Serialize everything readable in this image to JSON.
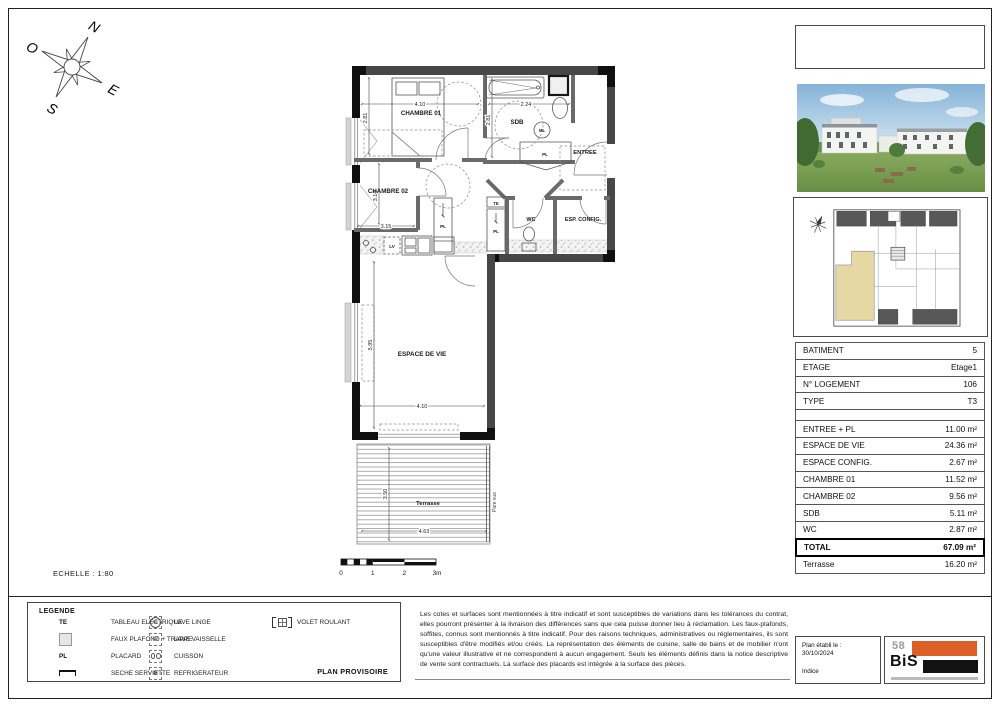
{
  "page": {
    "scale_label": "ECHELLE : 1:80",
    "plan_status": "PLAN PROVISOIRE"
  },
  "compass": {
    "n": "N",
    "o": "O",
    "e": "E",
    "s": "S"
  },
  "plan": {
    "rooms": {
      "chambre01": "CHAMBRE 01",
      "sdb": "SDB",
      "entree": "ENTREE",
      "chambre02": "CHAMBRE 02",
      "wc": "WC",
      "esp_config": "ESP. CONFIG.",
      "espace_de_vie": "ESPACE DE VIE",
      "terrasse": "Terrasse"
    },
    "annotations": {
      "pare_vue": "Pare vue",
      "pl": "PL",
      "te": "TE",
      "lv": "LV",
      "ml": "ML"
    },
    "dims": {
      "chambre01_w": "4.10",
      "chambre01_h": "2.81",
      "sdb_w": "2.24",
      "sdb_h": "2.81",
      "chambre02_w": "3.15",
      "chambre02_h": "3.14",
      "vie_w": "4.10",
      "vie_h": "5.95",
      "terrasse_w": "4.63",
      "terrasse_h": "3.50"
    },
    "scale_bar": {
      "t0": "0",
      "t1": "1",
      "t2": "2",
      "t3": "3m"
    }
  },
  "info_table": {
    "rows": [
      {
        "label": "BATIMENT",
        "value": "5"
      },
      {
        "label": "ETAGE",
        "value": "Etage1"
      },
      {
        "label": "N° LOGEMENT",
        "value": "106"
      },
      {
        "label": "TYPE",
        "value": "T3"
      },
      {
        "label": "",
        "value": ""
      },
      {
        "label": "ENTREE + PL",
        "value": "11.00 m²"
      },
      {
        "label": "ESPACE DE VIE",
        "value": "24.36 m²"
      },
      {
        "label": "ESPACE CONFIG.",
        "value": "2.67 m²"
      },
      {
        "label": "CHAMBRE 01",
        "value": "11.52 m²"
      },
      {
        "label": "CHAMBRE 02",
        "value": "9.56 m²"
      },
      {
        "label": "SDB",
        "value": "5.11 m²"
      },
      {
        "label": "WC",
        "value": "2.87 m²"
      },
      {
        "label": "TOTAL",
        "value": "67.09 m²"
      },
      {
        "label": "Terrasse",
        "value": "16.20 m²"
      }
    ]
  },
  "legend": {
    "title": "LEGENDE",
    "snowflake": "❄",
    "items": [
      {
        "symbol": "TE",
        "label": "TABLEAU ELECTRIQUE"
      },
      {
        "symbol": "faux-plafond-square",
        "label": "FAUX PLAFOND + TRAPPE"
      },
      {
        "symbol": "PL",
        "label": "PLACARD"
      },
      {
        "symbol": "seche-serviette",
        "label": "SECHE SERVIETTE"
      },
      {
        "symbol": "ML",
        "label": "LAVE LINGE"
      },
      {
        "symbol": "LV",
        "label": "LAVE VAISSELLE"
      },
      {
        "symbol": "cuisson",
        "label": "CUISSON"
      },
      {
        "symbol": "refrigerateur",
        "label": "REFRIGERATEUR"
      },
      {
        "symbol": "volet-roulant",
        "label": "VOLET ROULANT"
      }
    ]
  },
  "notes": {
    "text": "Les cotes et surfaces sont mentionnées à titre indicatif et sont susceptibles de variations dans les tolérances du contrat, elles pourront présenter à la livraison des différences sans que cela puisse donner lieu à réclamation. Les faux-plafonds, soffites, connus sont mentionnés à titre indicatif. Pour des raisons techniques, administratives ou réglementaires, ils sont susceptibles d'être modifiés et/ou créés. La représentation des éléments de cuisine, salle de bains et de mobilier n'ont qu'une valeur illustrative et ne correspondent à aucun engagement. Seuls les éléments définis dans la notice descriptive de vente sont contractuels. La surface des placards est intégrée à la surface des pièces."
  },
  "footer": {
    "date_label": "Plan établi le :",
    "date": "30/10/2024",
    "indice": "Indice"
  },
  "logo": {
    "number": "58",
    "name": "BiS"
  },
  "colors": {
    "accent_orange": "#DD5F28",
    "wall_dark": "#474747",
    "unit_highlight": "#E6D8A4"
  }
}
